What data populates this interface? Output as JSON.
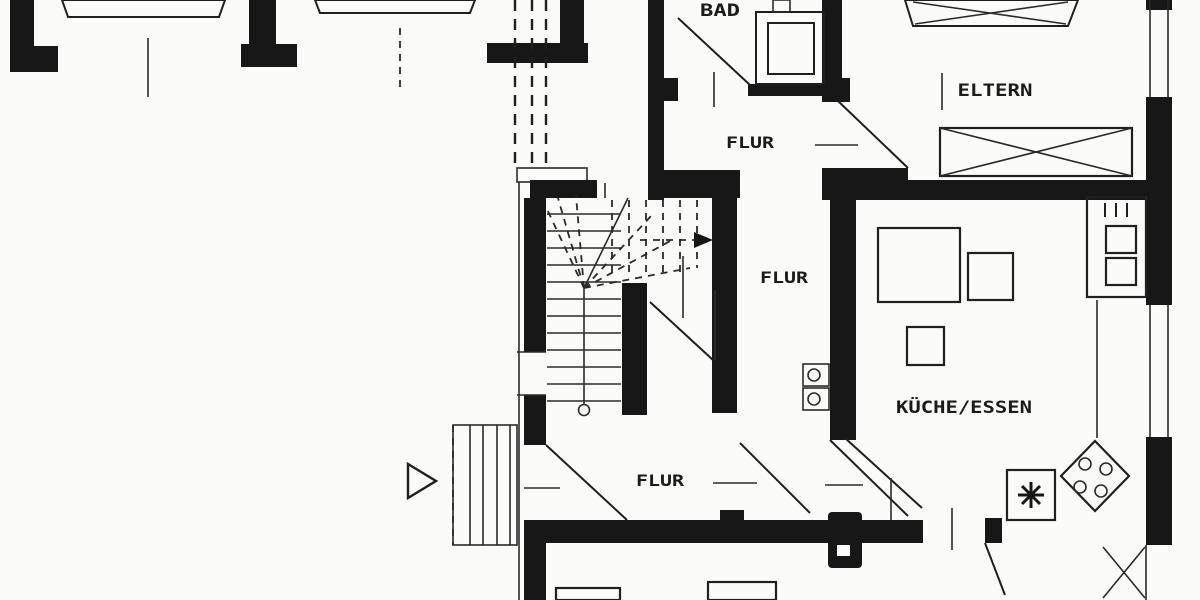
{
  "plan": {
    "type": "floor-plan",
    "floor": "Obergeschoss Grundriss",
    "labels": {
      "bad": "BAD",
      "flur_top": "FLUR",
      "eltern": "ELTERN",
      "flur_mid": "FLUR",
      "kueche": "KÜCHE/ESSEN",
      "flur_bottom": "FLUR"
    },
    "colors": {
      "ink": "#171717",
      "paper": "#fbfbf9"
    },
    "icons": [
      "shower-icon",
      "bed-icon",
      "wardrobe-icon",
      "stove-icon",
      "sink-icon",
      "oven-tower-icon",
      "chimney-icon",
      "radiator-icon",
      "stairs-icon",
      "entrance-arrow-icon",
      "door-swing-icon",
      "window-icon",
      "entrance-steps-icon"
    ]
  }
}
